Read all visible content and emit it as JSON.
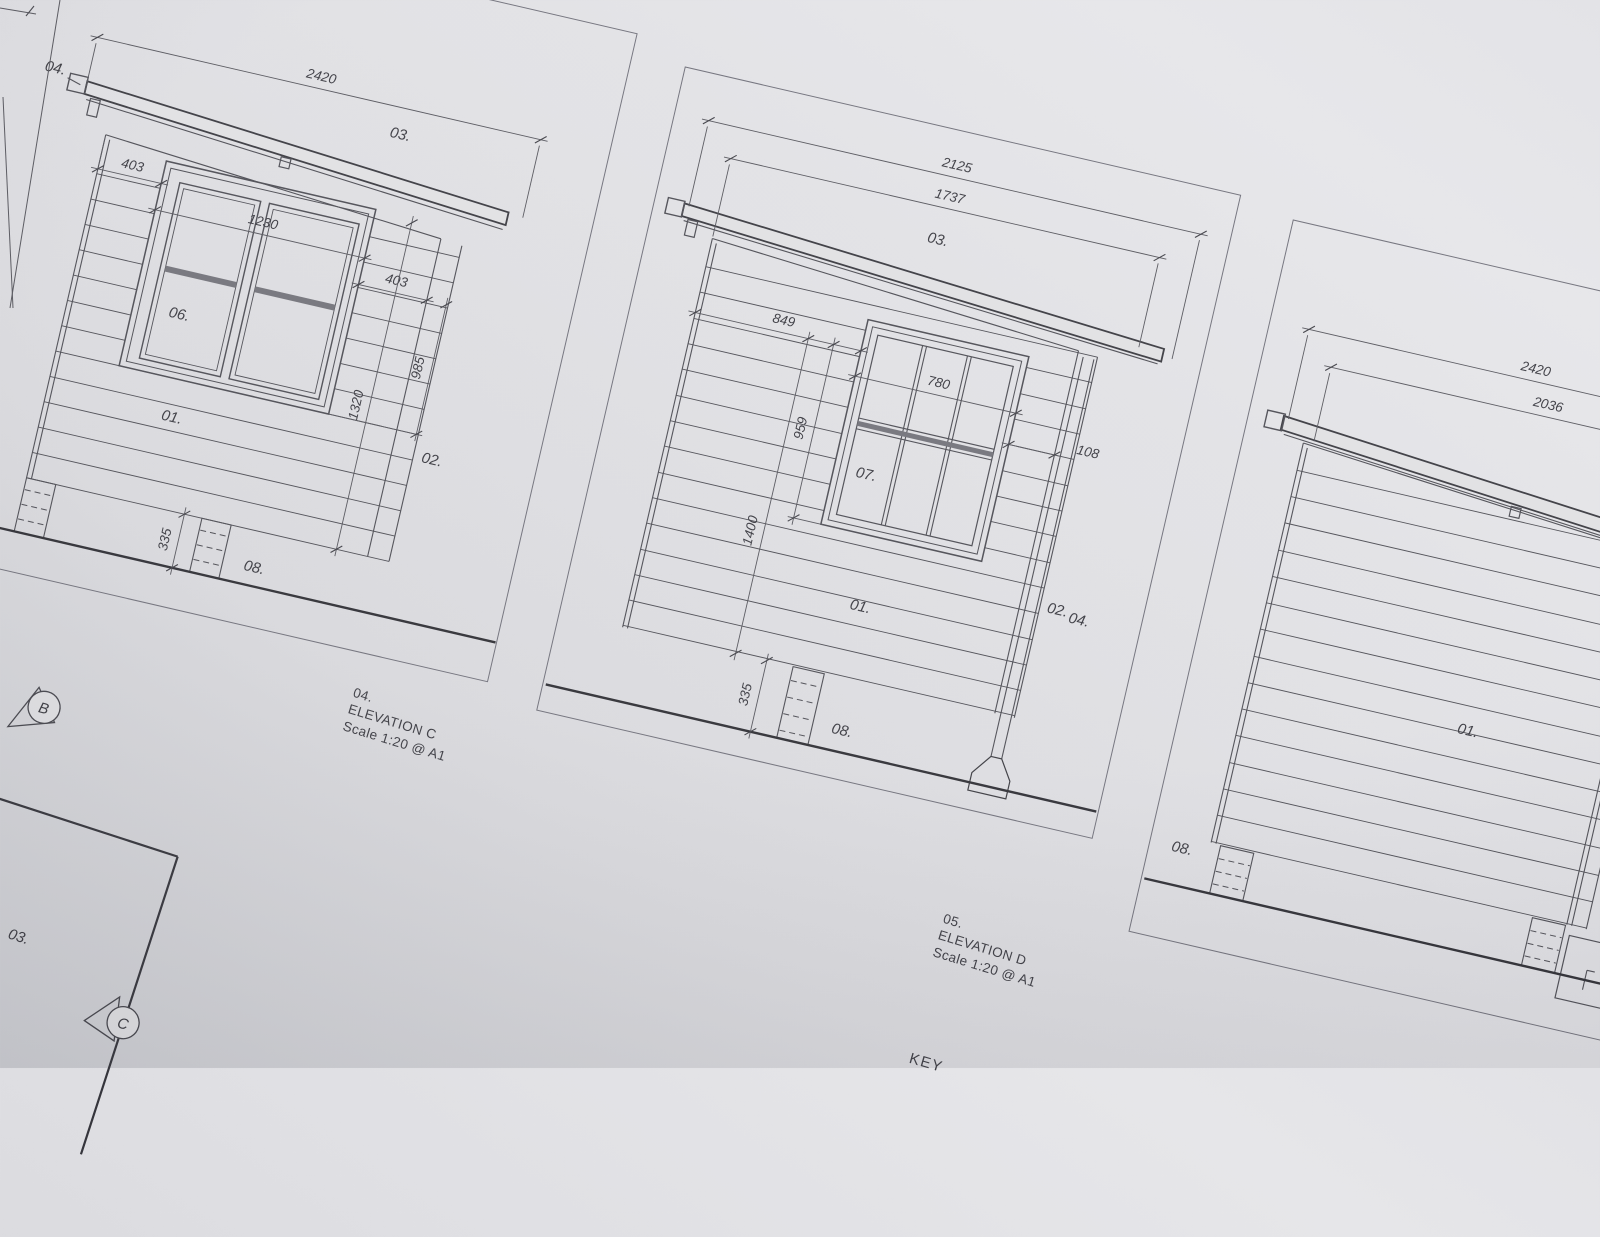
{
  "sheet": {
    "left_elevation": {
      "dims": {
        "width_overall": "2420",
        "left_offset": "403",
        "window_width": "1230",
        "right_offset": "403",
        "window_height": "985",
        "wall_height": "1320",
        "base_height": "335"
      },
      "tags": {
        "roof_edge": "04.",
        "roof": "03.",
        "window": "06.",
        "cladding": "01.",
        "corner_trim": "02.",
        "base": "08."
      }
    },
    "elevation_c": {
      "dims": {
        "width_overall": "2125",
        "width_inner": "1737",
        "left_offset": "849",
        "window_height": "959",
        "window_width": "780",
        "right_offset": "108",
        "wall_height": "1400",
        "base_height": "335"
      },
      "tags": {
        "roof": "03.",
        "window": "07.",
        "cladding": "01.",
        "corner_trim": "02.",
        "downpipe": "04.",
        "base": "08."
      },
      "title": {
        "number": "04.",
        "name": "ELEVATION C",
        "scale": "Scale 1:20 @ A1"
      }
    },
    "elevation_d": {
      "dims": {
        "width_overall": "2420",
        "width_inner": "2036"
      },
      "tags": {
        "cladding": "01.",
        "base": "08."
      },
      "title": {
        "number": "05.",
        "name": "ELEVATION D",
        "scale": "Scale 1:20 @ A1"
      }
    },
    "plan_fragment": {
      "tag": "03."
    },
    "section_markers": {
      "marker_b": "B",
      "marker_c": "C"
    },
    "key_heading": "KEY"
  }
}
